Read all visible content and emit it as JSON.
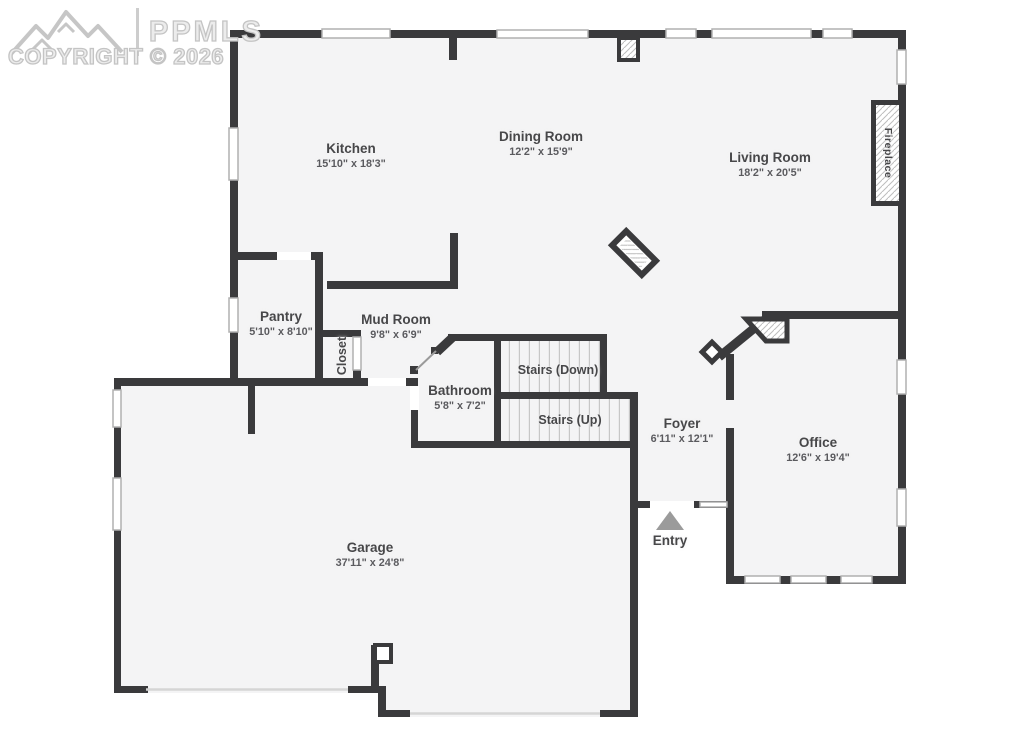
{
  "watermark": {
    "logo": "PPMLS",
    "copyright": "COPYRIGHT © 2026"
  },
  "rooms": {
    "kitchen": {
      "name": "Kitchen",
      "dims": "15'10\" x 18'3\""
    },
    "dining_room": {
      "name": "Dining Room",
      "dims": "12'2\" x 15'9\""
    },
    "living_room": {
      "name": "Living Room",
      "dims": "18'2\" x 20'5\""
    },
    "pantry": {
      "name": "Pantry",
      "dims": "5'10\" x 8'10\""
    },
    "mud_room": {
      "name": "Mud Room",
      "dims": "9'8\" x 6'9\""
    },
    "closet": {
      "name": "Closet"
    },
    "bathroom": {
      "name": "Bathroom",
      "dims": "5'8\" x 7'2\""
    },
    "stairs_down": {
      "name": "Stairs (Down)"
    },
    "stairs_up": {
      "name": "Stairs (Up)"
    },
    "foyer": {
      "name": "Foyer",
      "dims": "6'11\" x 12'1\""
    },
    "office": {
      "name": "Office",
      "dims": "12'6\" x 19'4\""
    },
    "garage": {
      "name": "Garage",
      "dims": "37'11\" x 24'8\""
    },
    "entry": {
      "name": "Entry"
    },
    "fireplace": {
      "name": "Fireplace"
    }
  },
  "colors": {
    "wall": "#3a3a3c",
    "floor": "#f4f4f5",
    "background": "#ffffff",
    "window_border": "#b0b0b0",
    "tread": "#c7c7c7",
    "label": "#474749",
    "dims": "#5a5a5e",
    "watermark": "#d4d4d4",
    "entry_arrow": "#9b9b9b"
  }
}
